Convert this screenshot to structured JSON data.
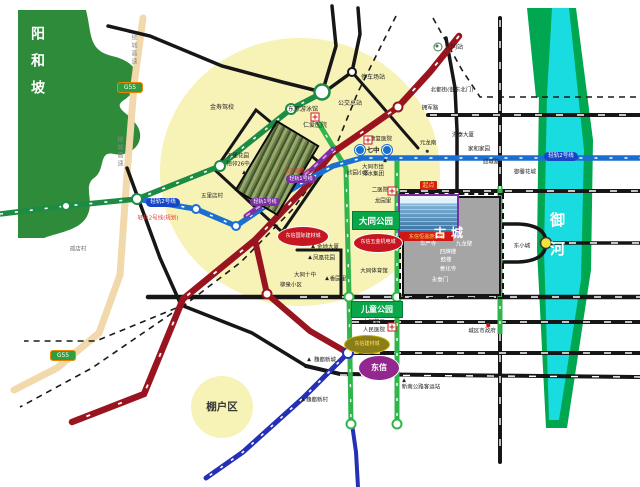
{
  "labels": {
    "yanghepo": "阳和坡",
    "penghuqu": "棚户区",
    "yuhe": "御河",
    "gucheng": "古城",
    "datong_park": "大同公园",
    "children_park": "儿童公园",
    "jinshou": "金寿驾校",
    "pool": "东原游泳馆",
    "renai": "仁爱医院",
    "bus_terminal": "公交总站",
    "parking": "停车场站",
    "wuli_garden_1": "五里花园",
    "wuli_garden_2": "相邻26中",
    "wulidian": "五里店村",
    "gudian": "孤店村",
    "hub": "公交枢纽站",
    "xinyuan": "欣园小区",
    "eryiyuan": "二医院",
    "longyuanli": "龙园里",
    "paishui_1": "大同市给",
    "paishui_2": "排水集团",
    "kangfu": "康复医院",
    "qizhong": "七中",
    "yuanlongnan": "元龙南",
    "hongtai": "洪泰大厦",
    "jiahe": "家和家园",
    "yingchenglu": "迎城路",
    "yuxin": "御馨花城",
    "datong_station": "大同站",
    "beidujie": "北都街(御东北门)",
    "yongjun": "拥军路",
    "dongxiaocheng": "东小城",
    "gov": "城区市政府",
    "coach": "新南公路客运站",
    "weidu_xincheng": "魏都新城",
    "weidu_xincun": "魏都新村",
    "hospital3_1": "大同第三",
    "hospital3_2": "人民医院",
    "jindi": "金地大厦",
    "fenghuang": "凤凰花园",
    "shizhong": "大同十中",
    "xiangyuanli": "香园里",
    "liuquan": "柳泉小区",
    "tiyuguan": "大同体育馆",
    "rail2_planned": "轻轨2号线(规划)",
    "rail2_badge": "轻轨2号线",
    "rail1_badge": "轻轨1号线",
    "qidian": "起点",
    "g55": "G55",
    "raocheng": "绕城高速",
    "ellipse_a": "东信国际建材城",
    "ellipse_b": "东信五金机电城",
    "ellipse_c": "东信建材城",
    "ellipse_d": "东信",
    "photo2_label": "东信恒温游泳馆",
    "gc_huayan": "华严寺",
    "gc_jiulong": "九龙壁",
    "gc_sipailou": "四牌楼",
    "gc_gulou": "鼓楼",
    "gc_shanhua": "善化寺",
    "gc_yongtai": "永泰门"
  },
  "colors": {
    "highlight_zone": "#F7F2B6",
    "mountain_green": "#2E8B3A",
    "river_cyan": "#18DCE0",
    "river_bank_green": "#00A650",
    "road_red": "#9A1420",
    "road_blue": "#1B6FD0",
    "road_green_dark": "#1C8C44",
    "road_green_bright": "#2FB54B",
    "road_purple": "#7B2FA3",
    "rail_navy": "#2430B5",
    "expressway_tan": "#F2D9AC",
    "old_city_gray": "#A5A5A5"
  }
}
